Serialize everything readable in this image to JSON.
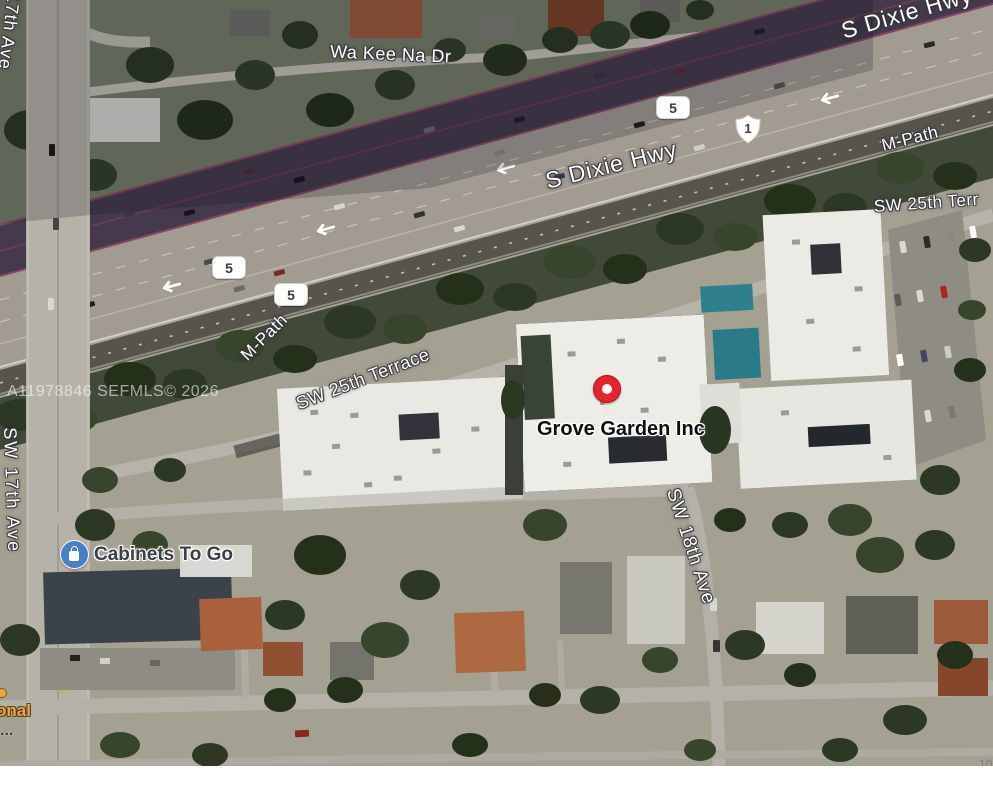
{
  "map": {
    "streets": {
      "ave17_top": "17th Ave",
      "wa_kee_na": "Wa Kee Na Dr",
      "dixie_top": "S Dixie Hwy",
      "dixie_mid": "S Dixie Hwy",
      "mpath_right": "M-Path",
      "mpath_left": "M-Path",
      "terr25_right": "SW 25th Terr",
      "terr25_mid": "SW 25th Terrace",
      "ave17_left": "SW 17th Ave",
      "ave18": "SW 18th Ave"
    },
    "shields": {
      "fl5_a": "5",
      "fl5_b": "5",
      "fl5_c": "5",
      "us1": "1"
    },
    "pois": {
      "grove_garden": "Grove Garden Inc",
      "cabinets": "Cabinets To Go"
    },
    "watermark": "A11978846 SEFMLS© 2026",
    "partials": {
      "left_clipped": "onal",
      "left_dots": "...",
      "bottom_right_clipped": "10"
    },
    "colors": {
      "pin_red": "#e4252e",
      "poi_blue": "#4a7fc7",
      "traffic_purple": "#453a4d",
      "roof_white": "#e9e9e4",
      "tree_green": "#2c3824"
    }
  }
}
